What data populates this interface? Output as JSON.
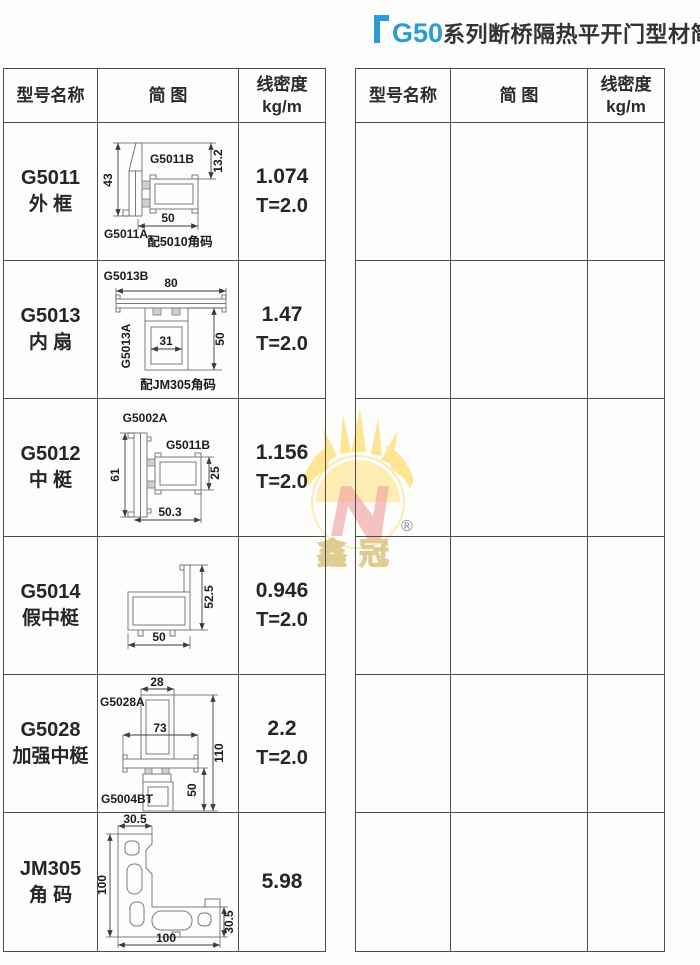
{
  "title": {
    "highlight": "G50",
    "text": "系列断桥隔热平开门型材简图"
  },
  "watermark": {
    "brand": "鑫冠",
    "registered": "®"
  },
  "colors": {
    "accent_blue": "#2b9cd8",
    "table_border": "#4d4d4d",
    "watermark_yellow": "#ffdf76",
    "watermark_red": "#e4524f"
  },
  "table_headers": {
    "model": "型号名称",
    "diagram": "简 图",
    "density_line1": "线密度",
    "density_line2": "kg/m"
  },
  "left_table": {
    "rows": [
      {
        "model": [
          "G5011",
          "外 框"
        ],
        "density": [
          "1.074",
          "T=2.0"
        ],
        "diagram": {
          "part_top": "G5011B",
          "part_bottom": "G5011A",
          "note": "配5010角码",
          "dim_left": "43",
          "dim_right": "13.2",
          "dim_bottom": "50"
        }
      },
      {
        "model": [
          "G5013",
          "内 扇"
        ],
        "density": [
          "1.47",
          "T=2.0"
        ],
        "diagram": {
          "part_top": "G5013B",
          "part_side": "G5013A",
          "note": "配JM305角码",
          "dim_top": "80",
          "dim_inner": "31",
          "dim_right": "50"
        }
      },
      {
        "model": [
          "G5012",
          "中 梃"
        ],
        "density": [
          "1.156",
          "T=2.0"
        ],
        "diagram": {
          "part_top": "G5002A",
          "part_right": "G5011B",
          "dim_left": "61",
          "dim_right": "25",
          "dim_bottom": "50.3"
        }
      },
      {
        "model": [
          "G5014",
          "假中梃"
        ],
        "density": [
          "0.946",
          "T=2.0"
        ],
        "diagram": {
          "dim_right": "52.5",
          "dim_bottom": "50"
        }
      },
      {
        "model": [
          "G5028",
          "加强中梃"
        ],
        "density": [
          "2.2",
          "T=2.0"
        ],
        "diagram": {
          "part_top": "G5028A",
          "part_bottom": "G5004BT",
          "dim_top": "28",
          "dim_mid": "73",
          "dim_right": "110",
          "dim_lower_right": "50"
        }
      },
      {
        "model": [
          "JM305",
          "角 码"
        ],
        "density": [
          "5.98",
          ""
        ],
        "diagram": {
          "dim_top": "30.5",
          "dim_left": "100",
          "dim_right": "30.5",
          "dim_bottom": "100"
        }
      }
    ]
  },
  "right_table": {
    "empty_row_count": 6
  }
}
